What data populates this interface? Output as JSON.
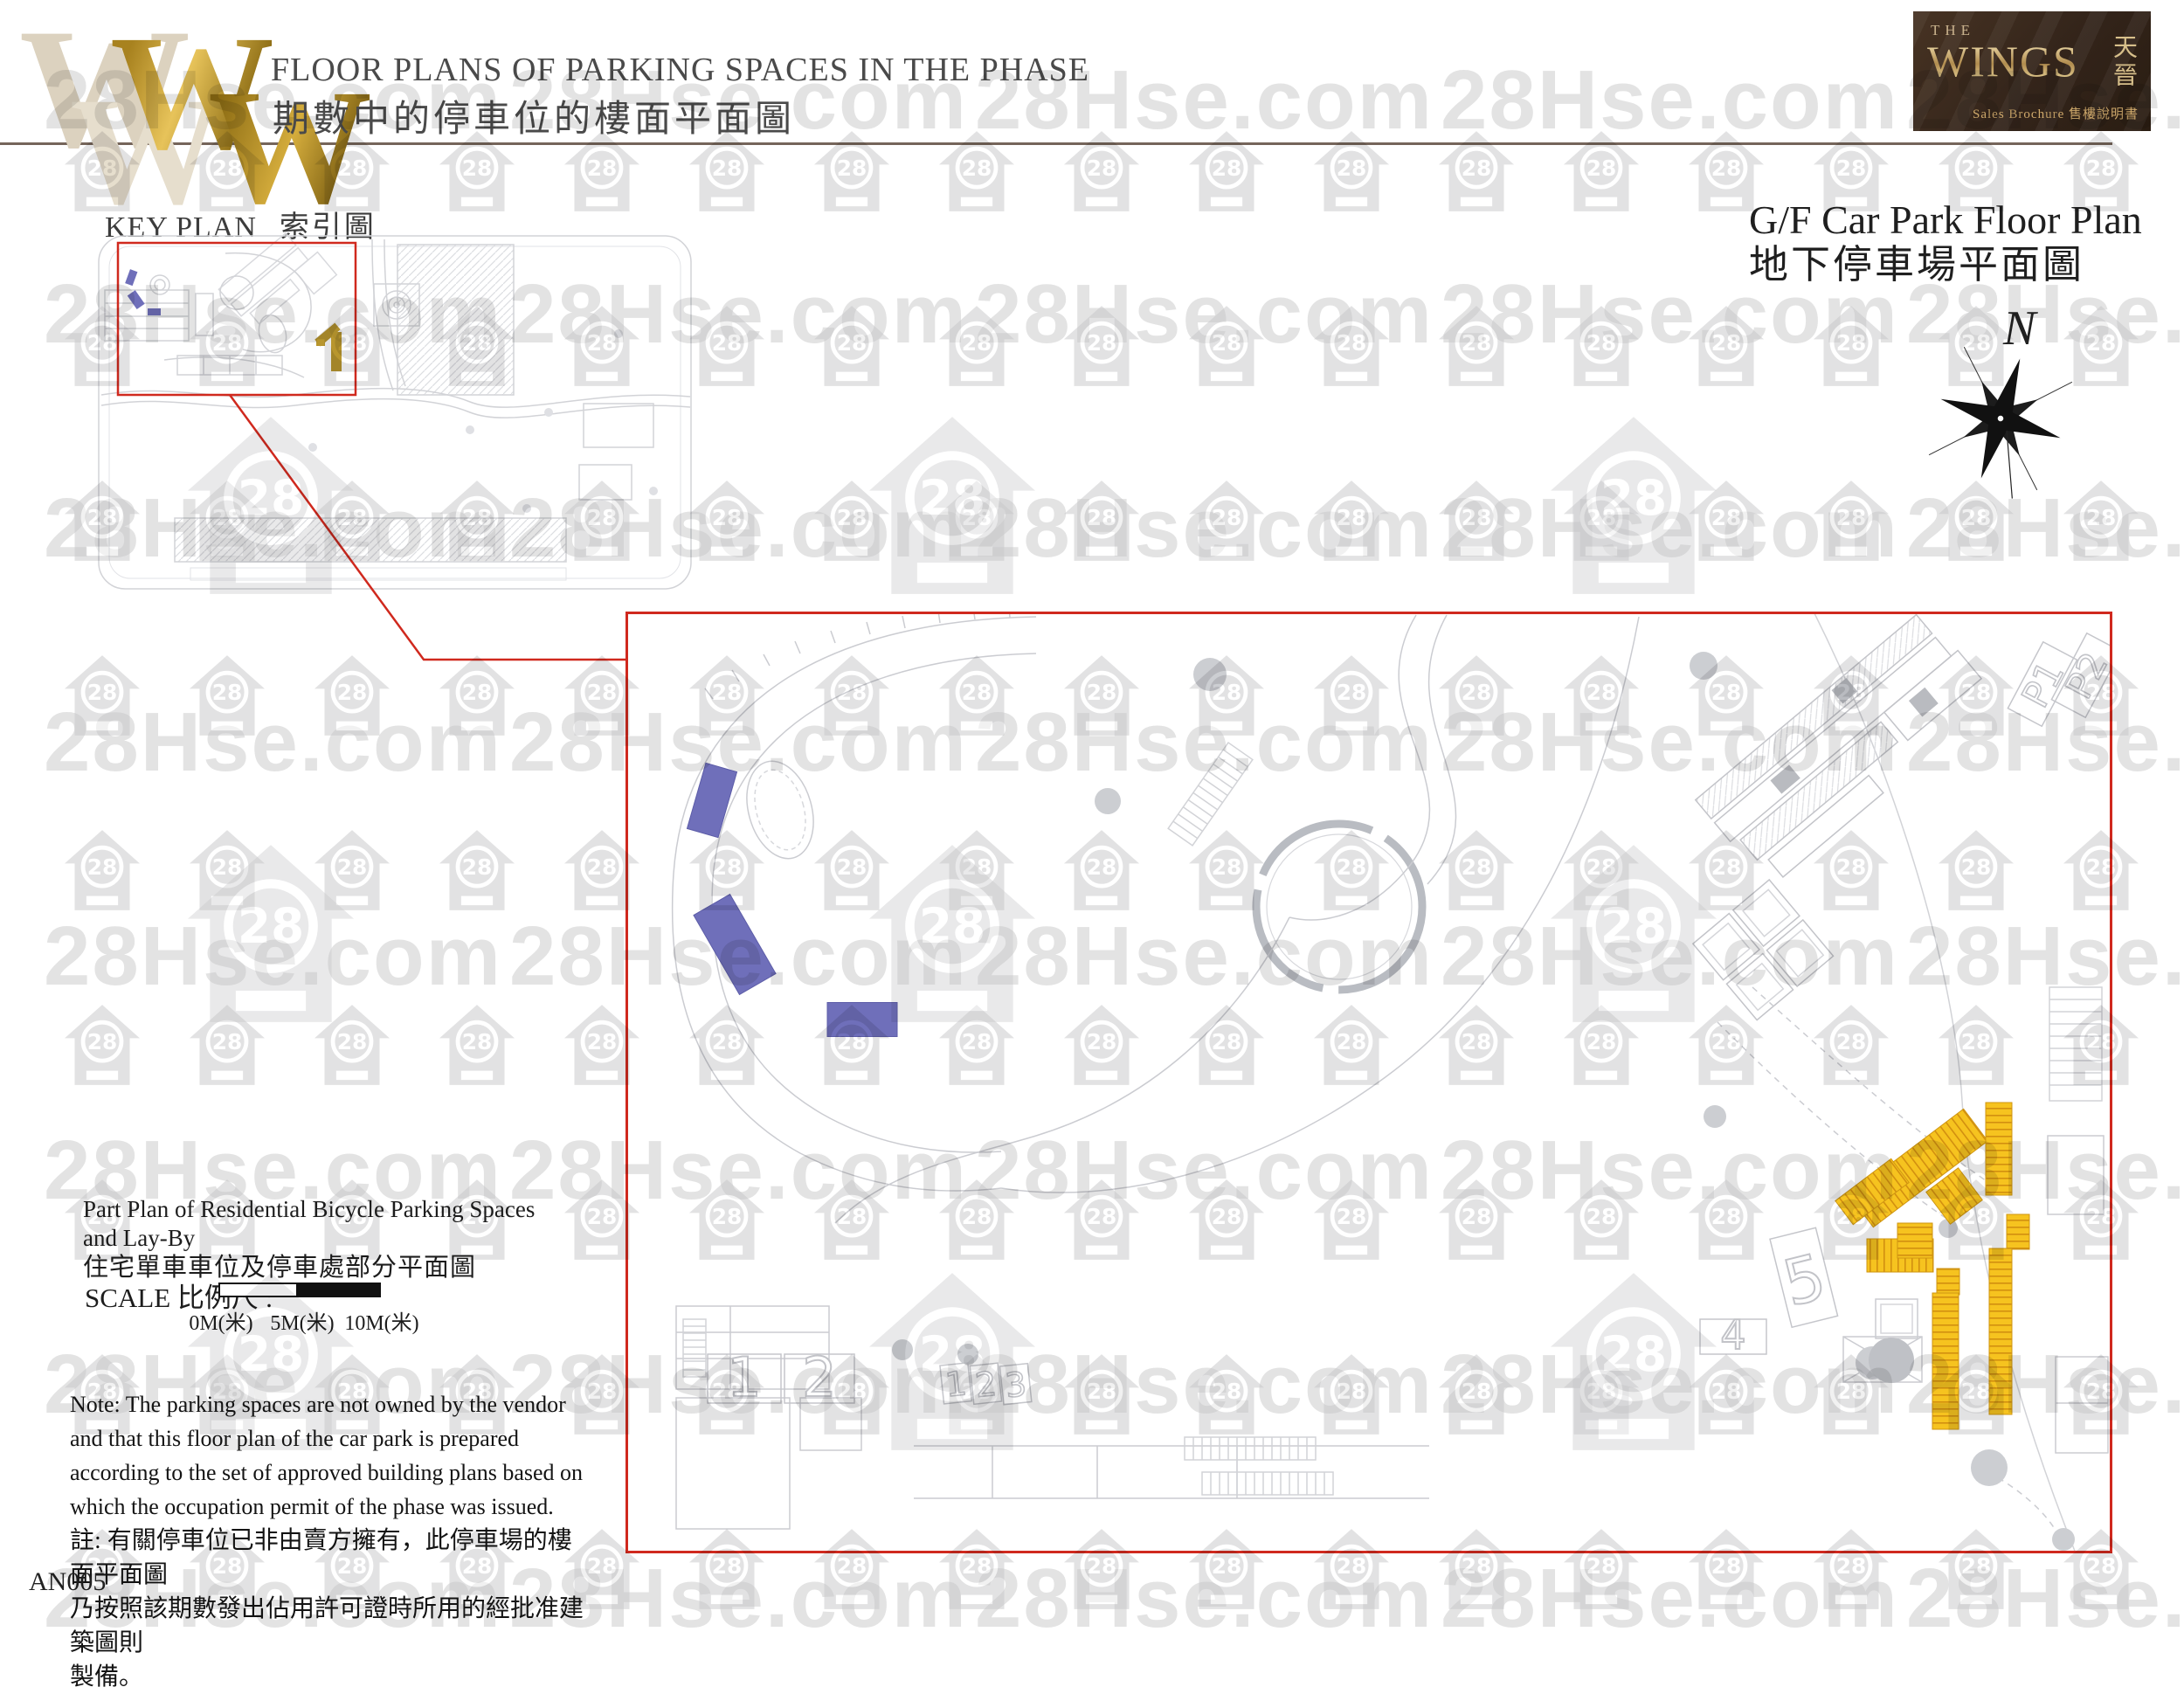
{
  "page": {
    "sheet_code": "AN005"
  },
  "watermark": {
    "text": "28Hse.com",
    "icon_label": "28"
  },
  "logo": {
    "letters": [
      "W",
      "W",
      "W",
      "W"
    ]
  },
  "header": {
    "title_en": "FLOOR PLANS OF PARKING SPACES IN THE PHASE",
    "title_zh": "期數中的停車位的樓面平面圖"
  },
  "badge": {
    "brand_prefix": "THE",
    "brand": "WINGS",
    "brand_zh": "天晉",
    "tagline": "Sales Brochure  售樓說明書"
  },
  "key_plan": {
    "label_en": "KEY PLAN",
    "label_zh": "索引圖"
  },
  "floor_plan": {
    "title_en": "G/F Car Park Floor Plan",
    "title_zh": "地下停車場平面圖",
    "compass_label": "N",
    "labels": {
      "block_big": [
        "1",
        "2"
      ],
      "block_small": [
        "1",
        "2",
        "3"
      ],
      "tower_4": "4",
      "tower_5": "5",
      "ramp": [
        "P1",
        "P2"
      ]
    }
  },
  "part_plan": {
    "title_en_line1": "Part Plan of Residential Bicycle Parking Spaces",
    "title_en_line2": "and Lay-By",
    "title_zh": "住宅單車車位及停車處部分平面圖"
  },
  "scale_bar": {
    "label_en": "SCALE",
    "label_zh": "比例尺",
    "colon": ":",
    "ticks": [
      "0M(米)",
      "5M(米)",
      "10M(米)"
    ]
  },
  "note": {
    "en_lines": [
      "Note: The parking spaces are not owned by the vendor",
      "and that this floor plan of the car park is prepared",
      "according to the set of approved building plans based on",
      "which the occupation permit of the phase was issued."
    ],
    "zh_lines": [
      "註: 有關停車位已非由賣方擁有，此停車場的樓面平面圖",
      "乃按照該期數發出佔用許可證時所用的經批准建築圖則",
      "製備。"
    ]
  },
  "colors": {
    "accent_red": "#d0291e",
    "parking_blue": "#6f6fba",
    "parking_yellow": "#f6c31f",
    "stall_stripe": "#d28f10",
    "key_gold": "#b8962e",
    "line_gray": "#cbccd1",
    "rule_brown": "#75655a",
    "badge_brown": "#33241a"
  }
}
